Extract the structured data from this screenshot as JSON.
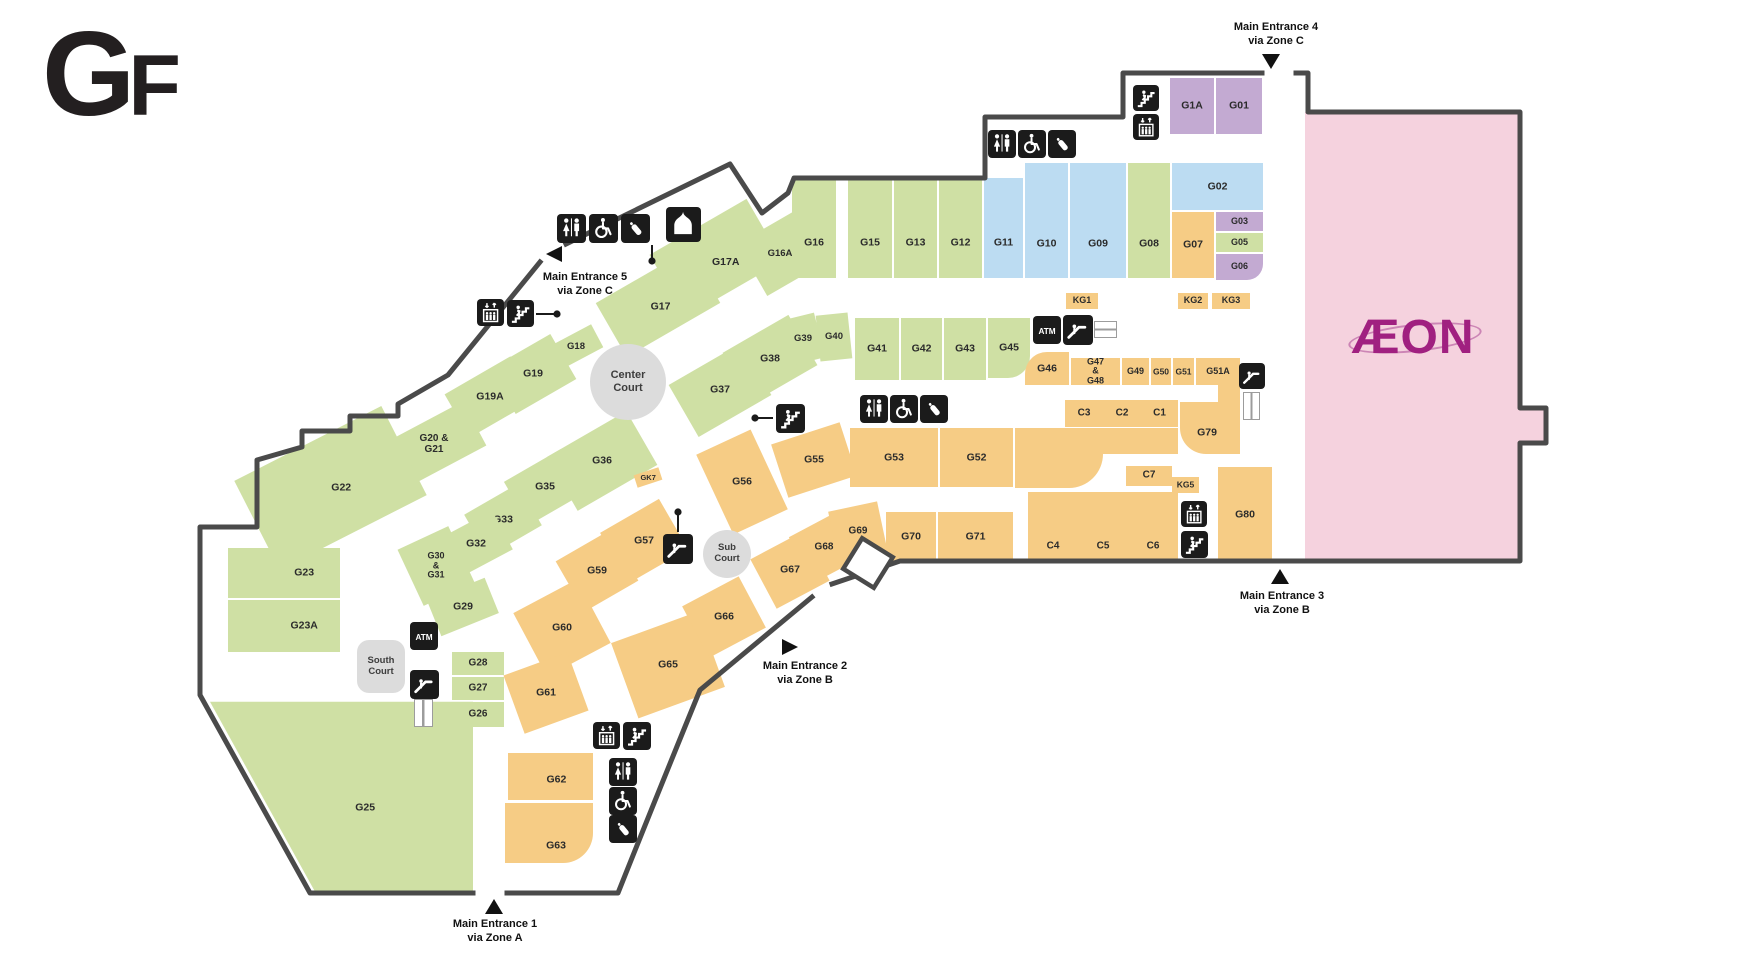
{
  "title": "GF",
  "atm_label": "ATM",
  "aeon": {
    "logo": "ÆON",
    "x": 1305,
    "y": 112,
    "w": 215,
    "h": 449,
    "bump": {
      "x": 1520,
      "y": 408,
      "w": 26,
      "h": 35
    },
    "logo_x": 1324,
    "logo_y": 302,
    "logo_w": 178,
    "logo_h": 70
  },
  "colors": {
    "green": "#cfe0a4",
    "blue": "#bcdcf2",
    "purple": "#c3aad2",
    "orange": "#f6cc85",
    "pink": "#f5d2de",
    "court": "#dcdcdc",
    "wall": "#4a4a4a",
    "icon_bg": "#1b1b1b"
  },
  "courts": [
    {
      "label": "Center\nCourt",
      "x": 590,
      "y": 344,
      "w": 76,
      "h": 76,
      "shape": "circle",
      "fs": 11
    },
    {
      "label": "Sub\nCourt",
      "x": 703,
      "y": 530,
      "w": 48,
      "h": 48,
      "shape": "circle",
      "fs": 9.5
    },
    {
      "label": "South\nCourt",
      "x": 357,
      "y": 640,
      "w": 48,
      "h": 53,
      "shape": "rect",
      "fs": 9.5
    }
  ],
  "entrances": [
    {
      "name": "Main Entrance 1",
      "via": "via Zone A",
      "dir": "up",
      "tx": 485,
      "ty": 899,
      "lx": 425,
      "ly": 917
    },
    {
      "name": "Main Entrance 2",
      "via": "via Zone B",
      "dir": "right",
      "tx": 782,
      "ty": 639,
      "lx": 735,
      "ly": 659
    },
    {
      "name": "Main Entrance 3",
      "via": "via Zone B",
      "dir": "up",
      "tx": 1271,
      "ty": 569,
      "lx": 1212,
      "ly": 589
    },
    {
      "name": "Main Entrance 4",
      "via": "via Zone C",
      "dir": "down",
      "tx": 1262,
      "ty": 54,
      "lx": 1206,
      "ly": 20
    },
    {
      "name": "Main Entrance 5",
      "via": "via Zone C",
      "dir": "left",
      "tx": 546,
      "ty": 246,
      "lx": 515,
      "ly": 270
    }
  ],
  "stores": [
    {
      "id": "G17",
      "c": "green",
      "x": 604,
      "y": 272,
      "w": 108,
      "h": 62,
      "r": -30,
      "ly": 0.58
    },
    {
      "id": "G17A",
      "c": "green",
      "x": 660,
      "y": 222,
      "w": 112,
      "h": 72,
      "r": -30,
      "lx": 0.55,
      "ly": 0.62
    },
    {
      "id": "G16A",
      "c": "green",
      "x": 748,
      "y": 224,
      "w": 64,
      "h": 60,
      "r": -30,
      "fs": 9.5
    },
    {
      "id": "G16",
      "c": "green",
      "x": 792,
      "y": 178,
      "w": 44,
      "h": 100,
      "ly": 0.65
    },
    {
      "id": "G15",
      "c": "green",
      "x": 848,
      "y": 178,
      "w": 44,
      "h": 100,
      "ly": 0.65
    },
    {
      "id": "G13",
      "c": "green",
      "x": 894,
      "y": 178,
      "w": 43,
      "h": 100,
      "ly": 0.65
    },
    {
      "id": "G12",
      "c": "green",
      "x": 939,
      "y": 178,
      "w": 43,
      "h": 100,
      "ly": 0.65
    },
    {
      "id": "G11",
      "c": "blue",
      "x": 984,
      "y": 178,
      "w": 39,
      "h": 100,
      "ly": 0.65
    },
    {
      "id": "G10",
      "c": "blue",
      "x": 1025,
      "y": 163,
      "w": 43,
      "h": 115,
      "ly": 0.7
    },
    {
      "id": "G09",
      "c": "blue",
      "x": 1070,
      "y": 163,
      "w": 56,
      "h": 115,
      "ly": 0.7
    },
    {
      "id": "G08",
      "c": "green",
      "x": 1128,
      "y": 163,
      "w": 42,
      "h": 115,
      "ly": 0.7
    },
    {
      "id": "G07",
      "c": "orange",
      "x": 1172,
      "y": 212,
      "w": 42,
      "h": 66
    },
    {
      "id": "G02",
      "c": "blue",
      "x": 1172,
      "y": 163,
      "w": 91,
      "h": 47
    },
    {
      "id": "G03",
      "c": "purple",
      "x": 1216,
      "y": 212,
      "w": 47,
      "h": 19,
      "fs": 9
    },
    {
      "id": "G05",
      "c": "green",
      "x": 1216,
      "y": 233,
      "w": 47,
      "h": 19,
      "fs": 9
    },
    {
      "id": "G06",
      "c": "purple",
      "x": 1216,
      "y": 254,
      "w": 47,
      "h": 26,
      "br": "0 0 16px 0",
      "fs": 9
    },
    {
      "id": "G1A",
      "c": "purple",
      "x": 1170,
      "y": 78,
      "w": 44,
      "h": 56
    },
    {
      "id": "G01",
      "c": "purple",
      "x": 1216,
      "y": 78,
      "w": 46,
      "h": 56
    },
    {
      "id": "G18",
      "c": "green",
      "x": 552,
      "y": 334,
      "w": 48,
      "h": 26,
      "r": -28,
      "fs": 9.5
    },
    {
      "id": "G19",
      "c": "green",
      "x": 498,
      "y": 348,
      "w": 70,
      "h": 52,
      "r": -30
    },
    {
      "id": "G19A",
      "c": "green",
      "x": 452,
      "y": 372,
      "w": 76,
      "h": 50,
      "r": -30
    },
    {
      "id": "G20 & G21",
      "c": "green",
      "x": 388,
      "y": 420,
      "w": 92,
      "h": 50,
      "r": -28,
      "fs": 10
    },
    {
      "id": "G22",
      "c": "green",
      "x": 248,
      "y": 438,
      "w": 165,
      "h": 100,
      "r": -27,
      "lx": 0.56,
      "ly": 0.55
    },
    {
      "id": "G23",
      "c": "green",
      "x": 228,
      "y": 548,
      "w": 112,
      "h": 50,
      "lx": 0.68
    },
    {
      "id": "G23A",
      "c": "green",
      "x": 228,
      "y": 600,
      "w": 112,
      "h": 52,
      "lx": 0.68
    },
    {
      "id": "G25",
      "c": "green",
      "x": 210,
      "y": 660,
      "w": 263,
      "h": 232,
      "clip": "polygon(0% 18%, 100% 18%, 100% 100%, 40% 100%)",
      "lx": 0.59,
      "ly": 0.64
    },
    {
      "id": "G36",
      "c": "green",
      "x": 556,
      "y": 430,
      "w": 92,
      "h": 62,
      "r": -30
    },
    {
      "id": "G35",
      "c": "green",
      "x": 512,
      "y": 462,
      "w": 66,
      "h": 50,
      "r": -30
    },
    {
      "id": "G33",
      "c": "green",
      "x": 472,
      "y": 496,
      "w": 62,
      "h": 48,
      "r": -30
    },
    {
      "id": "G32",
      "c": "green",
      "x": 446,
      "y": 522,
      "w": 60,
      "h": 44,
      "r": -28
    },
    {
      "id": "G30 & G31",
      "label": "G30\n&\nG31",
      "c": "green",
      "x": 408,
      "y": 535,
      "w": 56,
      "h": 62,
      "r": -25,
      "fs": 9
    },
    {
      "id": "G29",
      "c": "green",
      "x": 432,
      "y": 588,
      "w": 62,
      "h": 38,
      "r": -22
    },
    {
      "id": "G28",
      "c": "green",
      "x": 452,
      "y": 652,
      "w": 52,
      "h": 23,
      "fs": 10
    },
    {
      "id": "G27",
      "c": "green",
      "x": 452,
      "y": 677,
      "w": 52,
      "h": 23,
      "fs": 10
    },
    {
      "id": "G26",
      "c": "green",
      "x": 452,
      "y": 702,
      "w": 52,
      "h": 25,
      "fs": 10,
      "br": "0 0 0 14px"
    },
    {
      "id": "G37",
      "c": "green",
      "x": 678,
      "y": 360,
      "w": 84,
      "h": 60,
      "r": -30
    },
    {
      "id": "G38",
      "c": "green",
      "x": 732,
      "y": 330,
      "w": 76,
      "h": 58,
      "r": -30
    },
    {
      "id": "G39",
      "c": "green",
      "x": 786,
      "y": 316,
      "w": 34,
      "h": 46,
      "r": -14,
      "fs": 9.5
    },
    {
      "id": "G40",
      "c": "green",
      "x": 818,
      "y": 314,
      "w": 32,
      "h": 46,
      "r": -6,
      "fs": 9.5
    },
    {
      "id": "G41",
      "c": "green",
      "x": 855,
      "y": 318,
      "w": 44,
      "h": 62
    },
    {
      "id": "G42",
      "c": "green",
      "x": 901,
      "y": 318,
      "w": 41,
      "h": 62
    },
    {
      "id": "G43",
      "c": "green",
      "x": 944,
      "y": 318,
      "w": 42,
      "h": 62
    },
    {
      "id": "G45",
      "c": "green",
      "x": 988,
      "y": 318,
      "w": 42,
      "h": 60,
      "br": "0 0 22px 0"
    },
    {
      "id": "G46",
      "c": "orange",
      "x": 1025,
      "y": 352,
      "w": 44,
      "h": 33,
      "br": "22px 0 0 0"
    },
    {
      "id": "G47 & G48",
      "c": "orange",
      "x": 1071,
      "y": 358,
      "w": 49,
      "h": 27,
      "fs": 9
    },
    {
      "id": "G49",
      "c": "orange",
      "x": 1122,
      "y": 358,
      "w": 27,
      "h": 27,
      "fs": 9
    },
    {
      "id": "G50",
      "c": "orange",
      "x": 1151,
      "y": 358,
      "w": 20,
      "h": 27,
      "fs": 8.5
    },
    {
      "id": "G51",
      "c": "orange",
      "x": 1173,
      "y": 358,
      "w": 21,
      "h": 27,
      "fs": 8.5
    },
    {
      "id": "G51A",
      "c": "orange",
      "x": 1196,
      "y": 358,
      "w": 44,
      "h": 27,
      "fs": 9
    },
    {
      "id": "C3",
      "c": "orange",
      "x": 1065,
      "y": 400,
      "w": 38,
      "h": 27,
      "fs": 10
    },
    {
      "id": "C2",
      "c": "orange",
      "x": 1103,
      "y": 400,
      "w": 38,
      "h": 27,
      "fs": 10
    },
    {
      "id": "C1",
      "c": "orange",
      "x": 1141,
      "y": 400,
      "w": 37,
      "h": 27,
      "fs": 10
    },
    {
      "id": "G79",
      "c": "orange",
      "x": 1180,
      "y": 402,
      "w": 60,
      "h": 52,
      "br": "0 0 0 26px",
      "lx": 0.45,
      "ly": 0.6
    },
    {
      "id": "C7",
      "c": "orange",
      "x": 1126,
      "y": 466,
      "w": 46,
      "h": 20,
      "fs": 10
    },
    {
      "id": "KG5",
      "c": "orange",
      "x": 1172,
      "y": 477,
      "w": 27,
      "h": 16,
      "fs": 8.5
    },
    {
      "id": "C4",
      "c": "orange",
      "x": 1028,
      "y": 492,
      "w": 50,
      "h": 70,
      "ly": 0.78,
      "fs": 10
    },
    {
      "id": "C5",
      "c": "orange",
      "x": 1078,
      "y": 492,
      "w": 50,
      "h": 70,
      "ly": 0.78,
      "fs": 10
    },
    {
      "id": "C6",
      "c": "orange",
      "x": 1128,
      "y": 492,
      "w": 50,
      "h": 70,
      "ly": 0.78,
      "fs": 10
    },
    {
      "id": "G80",
      "c": "orange",
      "x": 1218,
      "y": 467,
      "w": 54,
      "h": 95
    },
    {
      "id": "G55",
      "c": "orange",
      "x": 778,
      "y": 432,
      "w": 72,
      "h": 56,
      "r": -18
    },
    {
      "id": "G53",
      "c": "orange",
      "x": 850,
      "y": 428,
      "w": 88,
      "h": 59
    },
    {
      "id": "G52",
      "c": "orange",
      "x": 940,
      "y": 428,
      "w": 73,
      "h": 59
    },
    {
      "id": "G56",
      "c": "orange",
      "x": 712,
      "y": 438,
      "w": 60,
      "h": 88,
      "r": -25
    },
    {
      "id": "G57",
      "c": "orange",
      "x": 610,
      "y": 512,
      "w": 68,
      "h": 58,
      "r": -30
    },
    {
      "id": "G59",
      "c": "orange",
      "x": 566,
      "y": 542,
      "w": 62,
      "h": 58,
      "r": -30
    },
    {
      "id": "G60",
      "c": "orange",
      "x": 526,
      "y": 592,
      "w": 72,
      "h": 72,
      "r": -28
    },
    {
      "id": "G61",
      "c": "orange",
      "x": 512,
      "y": 662,
      "w": 68,
      "h": 62,
      "r": -20
    },
    {
      "id": "G62",
      "c": "orange",
      "x": 508,
      "y": 753,
      "w": 85,
      "h": 47,
      "lx": 0.57,
      "ly": 0.58
    },
    {
      "id": "G63",
      "c": "orange",
      "x": 505,
      "y": 803,
      "w": 88,
      "h": 60,
      "br": "0 0 30px 0",
      "lx": 0.58,
      "ly": 0.72
    },
    {
      "id": "G65",
      "c": "orange",
      "x": 622,
      "y": 625,
      "w": 92,
      "h": 80,
      "r": -20
    },
    {
      "id": "G66",
      "c": "orange",
      "x": 692,
      "y": 588,
      "w": 64,
      "h": 58,
      "r": -28
    },
    {
      "id": "G67",
      "c": "orange",
      "x": 760,
      "y": 542,
      "w": 60,
      "h": 56,
      "r": -28
    },
    {
      "id": "G68",
      "c": "orange",
      "x": 798,
      "y": 522,
      "w": 52,
      "h": 52,
      "r": -28,
      "fs": 10
    },
    {
      "id": "G69",
      "c": "orange",
      "x": 833,
      "y": 506,
      "w": 50,
      "h": 52,
      "r": -12,
      "fs": 10
    },
    {
      "id": "G70",
      "c": "orange",
      "x": 886,
      "y": 512,
      "w": 50,
      "h": 50
    },
    {
      "id": "G71",
      "c": "orange",
      "x": 938,
      "y": 512,
      "w": 75,
      "h": 50
    },
    {
      "id": "KG1",
      "c": "orange",
      "x": 1066,
      "y": 293,
      "w": 32,
      "h": 16,
      "fs": 9
    },
    {
      "id": "KG2",
      "c": "orange",
      "x": 1178,
      "y": 293,
      "w": 30,
      "h": 16,
      "fs": 9
    },
    {
      "id": "KG3",
      "c": "orange",
      "x": 1212,
      "y": 293,
      "w": 38,
      "h": 16,
      "fs": 9
    },
    {
      "id": "GK7",
      "c": "orange",
      "x": 635,
      "y": 471,
      "w": 26,
      "h": 13,
      "fs": 7.5,
      "r": -18
    }
  ],
  "deco": [
    {
      "c": "orange",
      "x": 1015,
      "y": 428,
      "w": 163,
      "h": 26
    },
    {
      "c": "orange",
      "x": 1015,
      "y": 452,
      "w": 88,
      "h": 36,
      "br": "0 0 34px 0"
    },
    {
      "c": "orange",
      "x": 1218,
      "y": 385,
      "w": 22,
      "h": 20
    }
  ],
  "icons": [
    {
      "type": "toilet",
      "x": 557,
      "y": 214,
      "s": 29
    },
    {
      "type": "wheelchair",
      "x": 589,
      "y": 214,
      "s": 29
    },
    {
      "type": "baby",
      "x": 621,
      "y": 214,
      "s": 29
    },
    {
      "type": "prayer",
      "x": 666,
      "y": 207,
      "s": 35
    },
    {
      "type": "elevator",
      "x": 477,
      "y": 299,
      "s": 27
    },
    {
      "type": "stairs",
      "x": 507,
      "y": 300,
      "s": 27
    },
    {
      "type": "toilet",
      "x": 988,
      "y": 130,
      "s": 28
    },
    {
      "type": "wheelchair",
      "x": 1018,
      "y": 130,
      "s": 28
    },
    {
      "type": "baby",
      "x": 1048,
      "y": 130,
      "s": 28
    },
    {
      "type": "stairs",
      "x": 1133,
      "y": 85,
      "s": 26
    },
    {
      "type": "elevator",
      "x": 1133,
      "y": 114,
      "s": 26
    },
    {
      "type": "stairs",
      "x": 776,
      "y": 404,
      "s": 29
    },
    {
      "type": "toilet",
      "x": 860,
      "y": 395,
      "s": 28
    },
    {
      "type": "wheelchair",
      "x": 890,
      "y": 395,
      "s": 28
    },
    {
      "type": "baby",
      "x": 920,
      "y": 395,
      "s": 28
    },
    {
      "type": "atm",
      "x": 1033,
      "y": 316,
      "s": 28
    },
    {
      "type": "escalator",
      "x": 1063,
      "y": 315,
      "s": 30
    },
    {
      "type": "escalator",
      "x": 1239,
      "y": 363,
      "s": 26
    },
    {
      "type": "escalator",
      "x": 663,
      "y": 534,
      "s": 30
    },
    {
      "type": "atm",
      "x": 410,
      "y": 622,
      "s": 28
    },
    {
      "type": "escalator",
      "x": 410,
      "y": 670,
      "s": 29
    },
    {
      "type": "elevator",
      "x": 593,
      "y": 722,
      "s": 27
    },
    {
      "type": "stairs",
      "x": 623,
      "y": 722,
      "s": 28
    },
    {
      "type": "toilet",
      "x": 609,
      "y": 758,
      "s": 28
    },
    {
      "type": "wheelchair",
      "x": 609,
      "y": 787,
      "s": 28
    },
    {
      "type": "baby",
      "x": 609,
      "y": 815,
      "s": 28
    },
    {
      "type": "elevator",
      "x": 1181,
      "y": 501,
      "s": 26
    },
    {
      "type": "stairs",
      "x": 1181,
      "y": 531,
      "s": 27
    }
  ],
  "tracks": [
    {
      "o": "h",
      "x": 1094,
      "y": 321,
      "w": 21,
      "h": 15
    },
    {
      "o": "v",
      "x": 1243,
      "y": 392,
      "w": 15,
      "h": 26
    },
    {
      "o": "v",
      "x": 414,
      "y": 699,
      "w": 17,
      "h": 26
    }
  ],
  "connectors": [
    {
      "x1": 536,
      "y1": 314,
      "x2": 557,
      "y2": 314
    },
    {
      "x1": 773,
      "y1": 418,
      "x2": 755,
      "y2": 418
    },
    {
      "x1": 678,
      "y1": 532,
      "x2": 678,
      "y2": 512
    },
    {
      "x1": 652,
      "y1": 245,
      "x2": 652,
      "y2": 261
    }
  ]
}
